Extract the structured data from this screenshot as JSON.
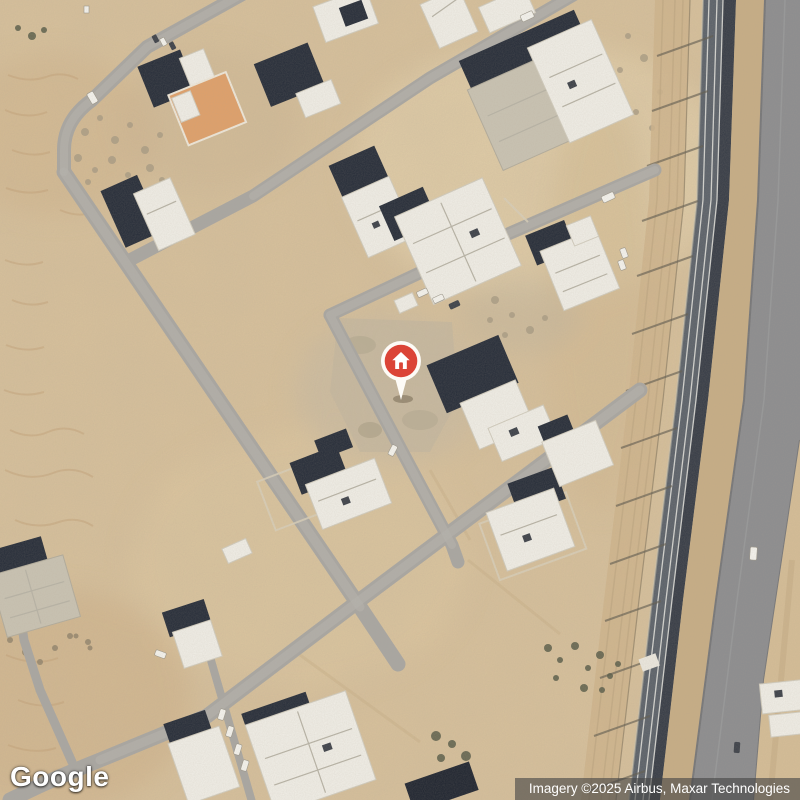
{
  "branding": {
    "logo_text": "Google"
  },
  "attribution": {
    "text": "Imagery ©2025 Airbus, Maxar Technologies"
  },
  "marker": {
    "kind": "property-home-pin",
    "icon": "home-icon",
    "pin_color": "#DB4437",
    "pin_ring_color": "#FDFBF6"
  },
  "palette": {
    "sand": "#D8C19B",
    "sand_light": "#E7D5AE",
    "sand_dark": "#C9AC82",
    "road_gray": "#A8A6A2",
    "roof_shadow_navy": "#232A37",
    "roof_white": "#F1EFE8",
    "concrete_gray": "#C9C3B3",
    "courtyard_orange": "#E0A069",
    "railway_dark": "#596069",
    "railway_darkest": "#343A45",
    "highway_gray": "#8B8C8F",
    "attribution_bg": "rgba(70,70,70,0.62)",
    "attribution_text": "#FFFFFF"
  }
}
